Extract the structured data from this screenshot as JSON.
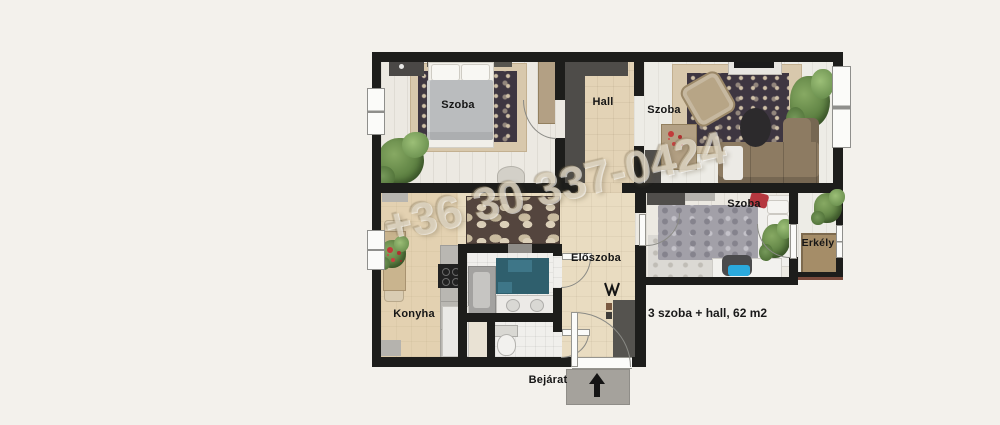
{
  "floorplan": {
    "watermark_text": "+36 30 337-0424",
    "summary_text": "3 szoba + hall, 62 m2",
    "rooms": {
      "bedroom1": {
        "label": "Szoba"
      },
      "hall": {
        "label": "Hall"
      },
      "living_room": {
        "label": "Szoba"
      },
      "bedroom2": {
        "label": "Szoba"
      },
      "balcony": {
        "label": "Erkély"
      },
      "kitchen": {
        "label": "Konyha"
      },
      "entry_hall": {
        "label": "Előszoba"
      },
      "entrance": {
        "label": "Bejárat"
      }
    },
    "colors": {
      "background": "#f3f1ec",
      "wall": "#1d1d1b",
      "floor_wood": "#ece9e2",
      "floor_tile_beige": "#e3d3b6",
      "bath_teal": "#2f5f6d",
      "chair_blue": "#2aa9dd",
      "pillow_red": "#b5373f",
      "plant_green": "#5d8344",
      "sofa_brown": "#8d7b62",
      "watermark_beige": "#d3c6ab"
    }
  }
}
